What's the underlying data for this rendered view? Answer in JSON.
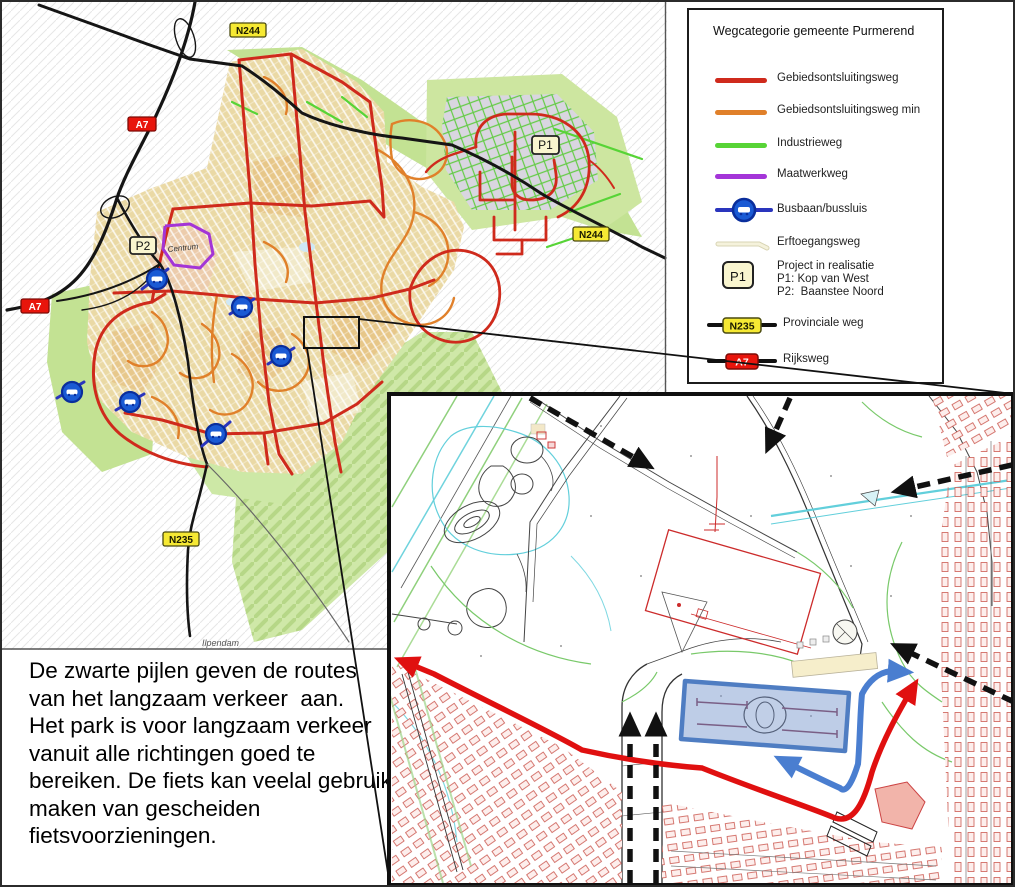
{
  "legend": {
    "title": "Wegcategorie gemeente Purmerend",
    "items": [
      {
        "id": "gebiedsontsluitingsweg",
        "label": "Gebiedsontsluitingsweg",
        "color": "#cf2a1c"
      },
      {
        "id": "gebiedsontsluitingsweg-min",
        "label": "Gebiedsontsluitingsweg min",
        "color": "#e0802a"
      },
      {
        "id": "industrieweg",
        "label": "Industrieweg",
        "color": "#57d436"
      },
      {
        "id": "maatwerkweg",
        "label": "Maatwerkweg",
        "color": "#a435d8"
      },
      {
        "id": "busbaan",
        "label": "Busbaan/bussluis",
        "color": "#2a35bd"
      },
      {
        "id": "erftoegangsweg",
        "label": "Erftoegangsweg",
        "color": "#f2efd3"
      }
    ],
    "project": {
      "badge": "P1",
      "line1": "Project in realisatie",
      "line2": "P1: Kop van West",
      "line3": "P2:  Baanstee Noord"
    },
    "provinciale": {
      "badge": "N235",
      "label": "Provinciale weg"
    },
    "rijksweg": {
      "badge": "A7",
      "label": "Rijksweg"
    }
  },
  "map": {
    "badges": {
      "n244_top": "N244",
      "n244_right": "N244",
      "a7_top": "A7",
      "a7_left": "A7",
      "n235": "N235",
      "p1": "P1",
      "p2": "P2"
    },
    "labels": {
      "centrum": "Centrum",
      "ilpendam": "Ilpendam"
    }
  },
  "annotation": {
    "lines": [
      "De zwarte pijlen geven de routes",
      "van het langzaam verkeer  aan.",
      "Het park is voor langzaam verkeer",
      "vanuit alle richtingen goed te",
      "bereiken. De fiets kan veelal gebruik",
      "maken van gescheiden",
      "fietsvoorzieningen."
    ]
  },
  "colors": {
    "red": "#cf2a1c",
    "orange": "#e0802a",
    "green": "#57d436",
    "purple": "#a435d8",
    "blue": "#2a35bd",
    "badge_yellow": "#f6e933",
    "badge_red": "#e8150c",
    "arrow_red": "#e01010",
    "arrow_blue": "#4a7ed0",
    "highlight_blue": "#4f7dc2"
  }
}
